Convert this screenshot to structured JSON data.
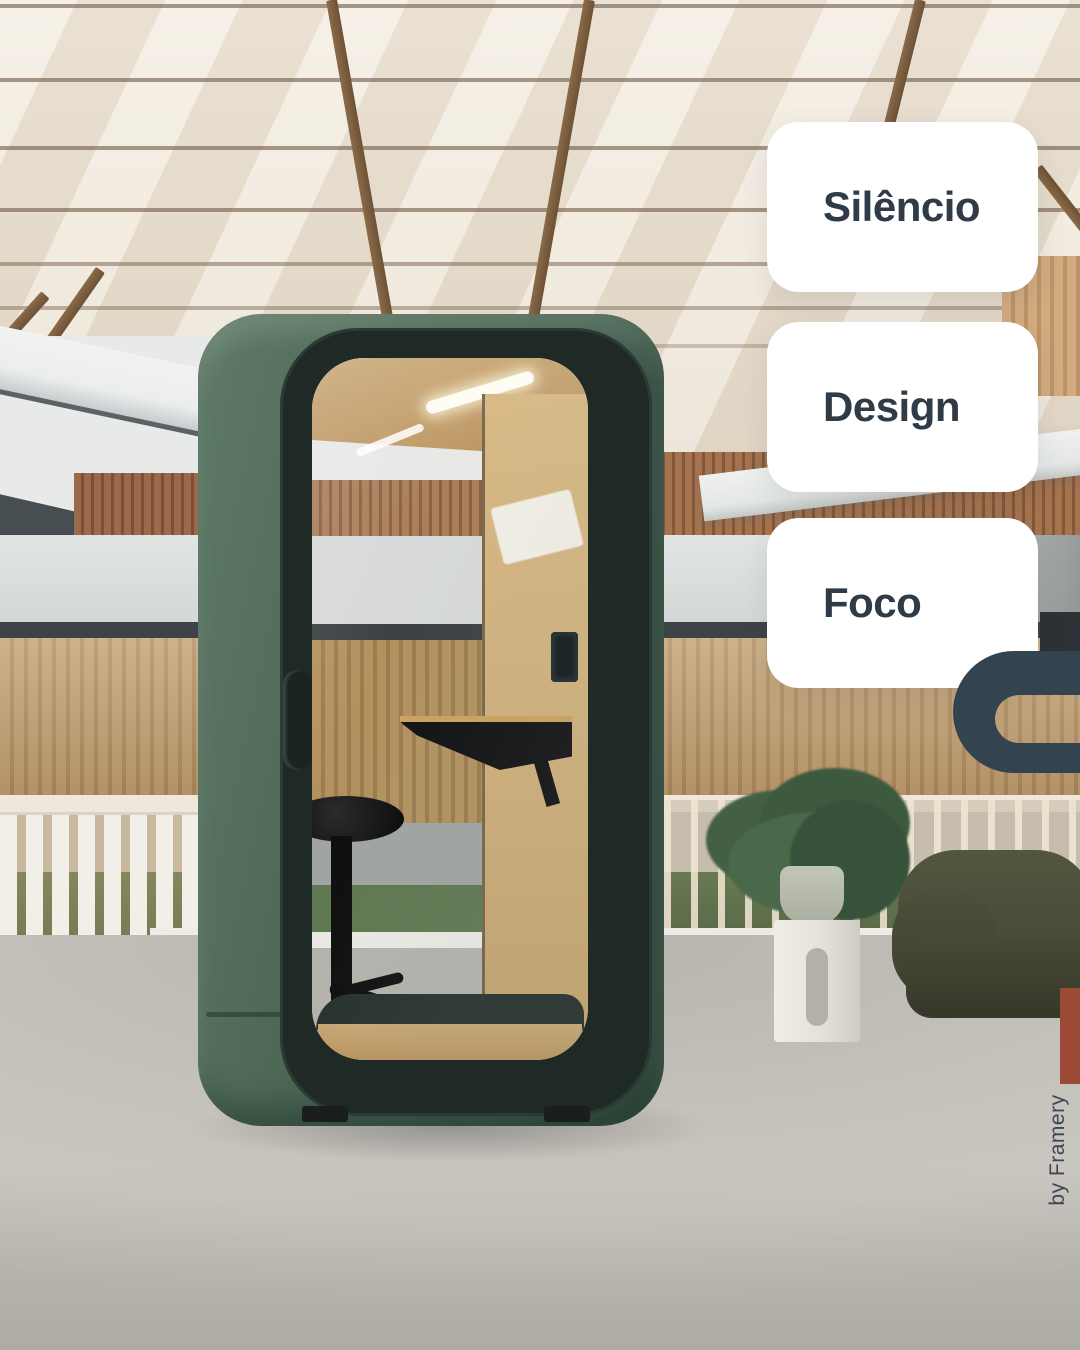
{
  "post": {
    "cards": [
      {
        "label": "Silêncio"
      },
      {
        "label": "Design"
      },
      {
        "label": "Foco"
      }
    ],
    "credit": "by Framery",
    "logo": "c-shape-logo",
    "colors": {
      "card_background": "#ffffff",
      "card_text": "#2f3c48",
      "logo": "#344350",
      "credit_text": "#3d4751",
      "booth_green": "#4d6856",
      "floor": "#c3bfb9"
    },
    "scene": {
      "subject": "green office phone booth with glass door in a bright atrium",
      "elements": [
        "skylight-ceiling",
        "wood-slat-wall",
        "railing",
        "potted-plant",
        "white-side-table",
        "olive-armchair",
        "carpet-floor",
        "stool",
        "desk"
      ]
    }
  }
}
